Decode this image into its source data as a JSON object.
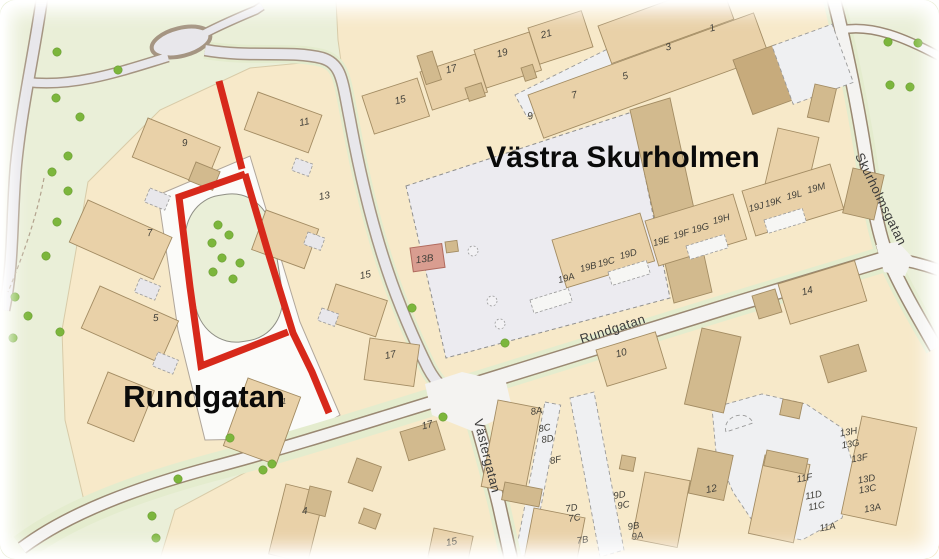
{
  "map": {
    "district_label": "Västra Skurholmen",
    "street_label_big": "Rundgatan",
    "streets": {
      "rundgatan": "Rundgatan",
      "vastergatan": "Västergatan",
      "skurholmsgatan": "Skurholmsgatan"
    },
    "highlighted_address": "13B",
    "colors": {
      "route_red": "#d7291b",
      "tree_green": "#7cb63c",
      "highlight_pink": "#d99d90",
      "block_cream": "#f7e9c9",
      "park_green": "#eaefd8"
    },
    "highlight": {
      "color": "#d7291b",
      "width": 7,
      "segments": [
        [
          [
            219,
            81
          ],
          [
            231,
            127
          ],
          [
            242,
            169
          ]
        ],
        [
          [
            245,
            174
          ],
          [
            179,
            197
          ],
          [
            190,
            287
          ],
          [
            201,
            366
          ],
          [
            288,
            332
          ]
        ],
        [
          [
            245,
            174
          ],
          [
            268,
            252
          ],
          [
            293,
            333
          ],
          [
            312,
            372
          ],
          [
            329,
            413
          ]
        ]
      ]
    },
    "house_numbers": {
      "w9": "9",
      "w7": "7",
      "w5": "5",
      "e11": "11",
      "e13": "13",
      "e15": "15",
      "e17": "17",
      "t15": "15",
      "t17": "17",
      "t19": "19",
      "t21": "21",
      "tr9": "9",
      "tr7": "7",
      "tr5": "5",
      "tr3": "3",
      "tr1": "1",
      "b13b": "13B",
      "r19a": "19A",
      "r19b": "19B",
      "r19c": "19C",
      "r19d": "19D",
      "r19e": "19E",
      "r19f": "19F",
      "r19g": "19G",
      "r19h": "19H",
      "r19j": "19J",
      "r19k": "19K",
      "r19l": "19L",
      "r19m": "19M",
      "s14": "14",
      "s10": "10",
      "s17": "17",
      "s12": "12",
      "s1": "1",
      "s4": "4",
      "s15": "15",
      "g8a": "8A",
      "g8c": "8C",
      "g8d": "8D",
      "g8f": "8F",
      "g7d": "7D",
      "g7c": "7C",
      "g7b": "7B",
      "g9d": "9D",
      "g9c": "9C",
      "g9b": "9B",
      "g9a": "9A",
      "g11f": "11F",
      "g11d": "11D",
      "g11c": "11C",
      "g11a": "11A",
      "g13h": "13H",
      "g13g": "13G",
      "g13f": "13F",
      "g13d": "13D",
      "g13c": "13C",
      "g13a": "13A"
    },
    "trees": [
      [
        57,
        52
      ],
      [
        118,
        70
      ],
      [
        56,
        98
      ],
      [
        80,
        117
      ],
      [
        68,
        156
      ],
      [
        52,
        172
      ],
      [
        68,
        191
      ],
      [
        57,
        222
      ],
      [
        46,
        256
      ],
      [
        15,
        297
      ],
      [
        28,
        316
      ],
      [
        13,
        338
      ],
      [
        60,
        332
      ],
      [
        218,
        225
      ],
      [
        229,
        235
      ],
      [
        212,
        243
      ],
      [
        222,
        258
      ],
      [
        240,
        263
      ],
      [
        213,
        272
      ],
      [
        233,
        279
      ],
      [
        888,
        42
      ],
      [
        918,
        43
      ],
      [
        890,
        85
      ],
      [
        910,
        87
      ],
      [
        412,
        308
      ],
      [
        505,
        343
      ],
      [
        443,
        417
      ],
      [
        230,
        438
      ],
      [
        263,
        470
      ],
      [
        272,
        464
      ],
      [
        178,
        479
      ],
      [
        152,
        516
      ],
      [
        156,
        538
      ]
    ],
    "parking_markers": [
      [
        473,
        251
      ],
      [
        492,
        301
      ],
      [
        500,
        324
      ]
    ]
  }
}
